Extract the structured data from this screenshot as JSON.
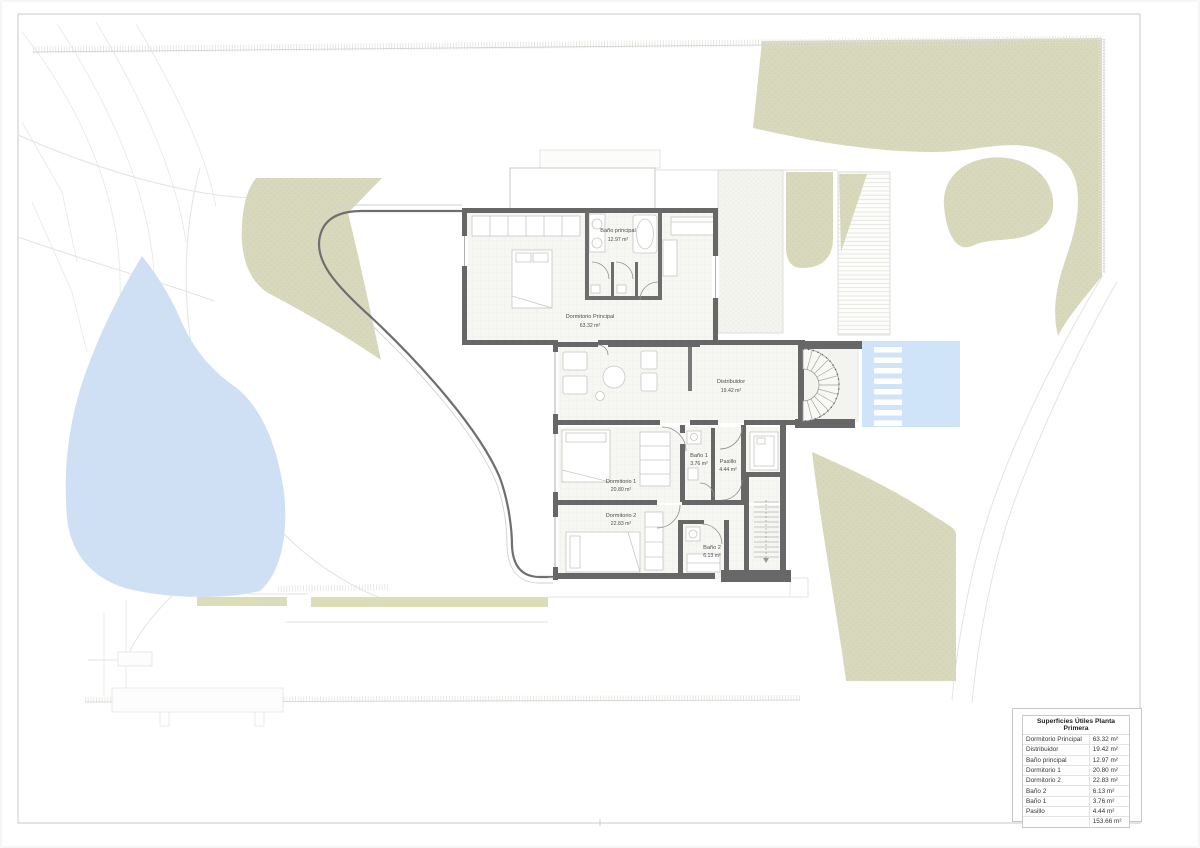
{
  "document": {
    "type": "architectural-floor-plan",
    "floor": "Planta Primera"
  },
  "plan": {
    "rooms": [
      {
        "name": "Dormitorio Principal",
        "area": "63.32 m²"
      },
      {
        "name": "Baño principal",
        "area": "12.97 m²"
      },
      {
        "name": "Distribuidor",
        "area": "19.42 m²"
      },
      {
        "name": "Dormitorio 1",
        "area": "20.80 m²"
      },
      {
        "name": "Baño 1",
        "area": "3.76 m²"
      },
      {
        "name": "Pasillo",
        "area": "4.44 m²"
      },
      {
        "name": "Dormitorio 2",
        "area": "22.83 m²"
      },
      {
        "name": "Baño 2",
        "area": "6.13 m²"
      }
    ]
  },
  "legend": {
    "title": "Superficies Útiles Planta Primera",
    "rows": [
      {
        "label": "Dormitorio Principal",
        "value": "63.32 m²"
      },
      {
        "label": "Distribuidor",
        "value": "19.42 m²"
      },
      {
        "label": "Baño principal",
        "value": "12.97 m²"
      },
      {
        "label": "Dormitorio 1",
        "value": "20.80 m²"
      },
      {
        "label": "Dormitorio 2",
        "value": "22.83 m²"
      },
      {
        "label": "Baño 2",
        "value": "6.13 m²"
      },
      {
        "label": "Baño 1",
        "value": "3.76 m²"
      },
      {
        "label": "Pasillo",
        "value": "4.44 m²"
      },
      {
        "label": "",
        "value": "153.66 m²"
      }
    ]
  },
  "colors": {
    "vegetation": "#d8d9bc",
    "pond": "#cfe0f4",
    "pool": "#cfe4f8",
    "wall": "#676767"
  }
}
